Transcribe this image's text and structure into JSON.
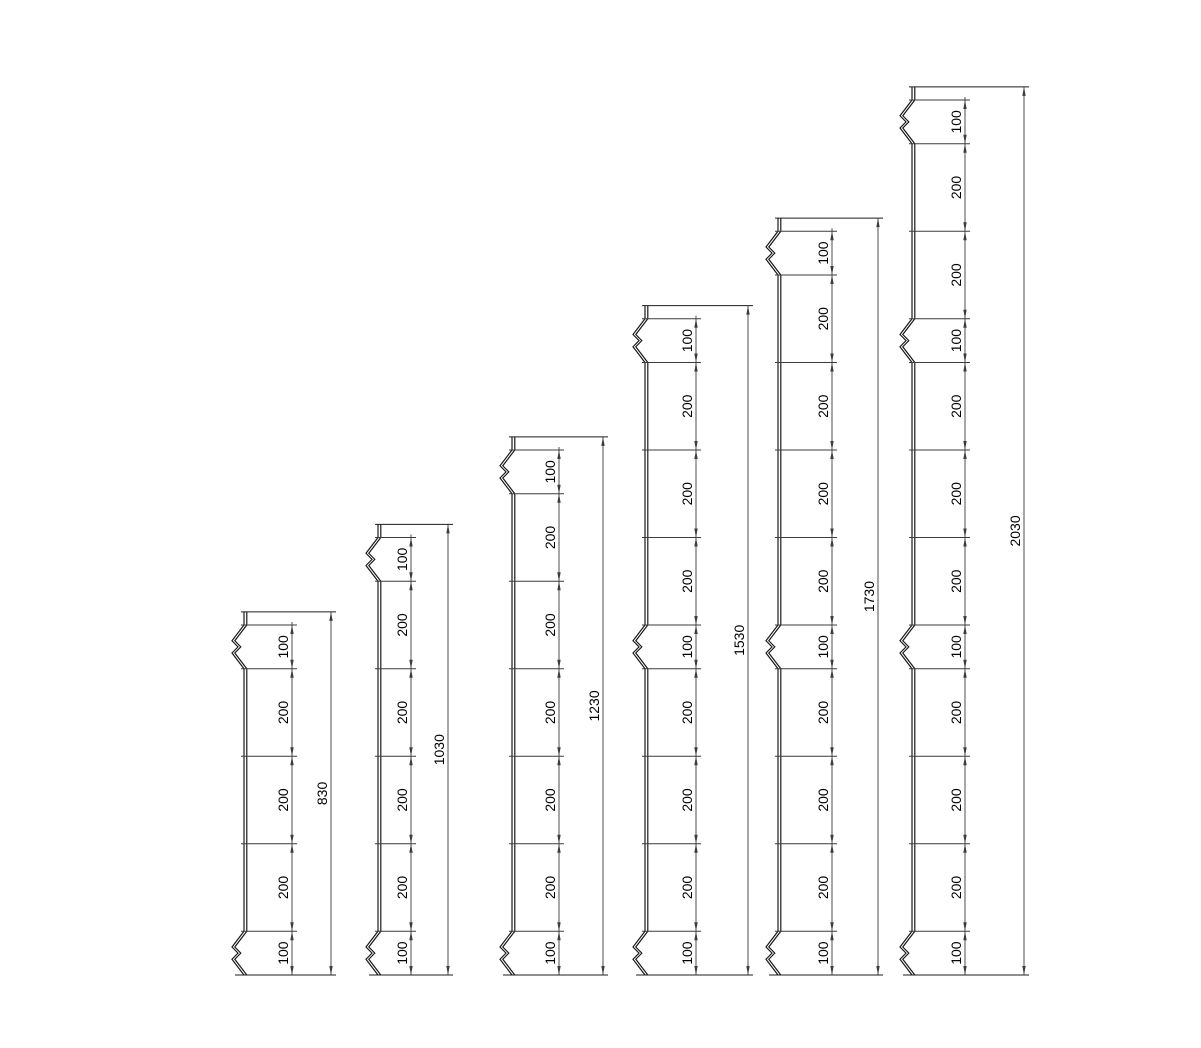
{
  "drawing": {
    "canvas": {
      "width": 1201,
      "height": 1048,
      "background": "#ffffff"
    },
    "style": {
      "profile_color": "#1c1c1c",
      "dimension_color": "#3c3c3c",
      "text_color": "#000000",
      "font_size_px": 14,
      "profile_stroke_px": 1.2,
      "dimension_stroke_px": 0.9
    },
    "units": "mm",
    "scale_px_per_mm": 0.4375,
    "baseline_y_px": 975,
    "top_cap_mm": 30,
    "crimp_shape": {
      "depth_px": 12,
      "notch_px": 6,
      "apex1_frac": 0.36,
      "mid_frac": 0.5,
      "apex2_frac": 0.64,
      "double_line_gap_px": 2.8
    },
    "posts": [
      {
        "name": "post-830",
        "overall_label": "830",
        "overall_mm": 830,
        "segments_mm": [
          100,
          200,
          200,
          200,
          100
        ],
        "segment_labels": [
          "100",
          "200",
          "200",
          "200",
          "100"
        ],
        "crimp_segments": [
          0,
          4
        ],
        "x_left_px": 244,
        "x_chain_px": 292,
        "x_dim_px": 331
      },
      {
        "name": "post-1030",
        "overall_label": "1030",
        "overall_mm": 1030,
        "segments_mm": [
          100,
          200,
          200,
          200,
          200,
          100
        ],
        "segment_labels": [
          "100",
          "200",
          "200",
          "200",
          "200",
          "100"
        ],
        "crimp_segments": [
          0,
          5
        ],
        "x_left_px": 378,
        "x_chain_px": 411,
        "x_dim_px": 448
      },
      {
        "name": "post-1230",
        "overall_label": "1230",
        "overall_mm": 1230,
        "segments_mm": [
          100,
          200,
          200,
          200,
          200,
          200,
          100
        ],
        "segment_labels": [
          "100",
          "200",
          "200",
          "200",
          "200",
          "200",
          "100"
        ],
        "crimp_segments": [
          0,
          6
        ],
        "x_left_px": 512,
        "x_chain_px": 559,
        "x_dim_px": 603
      },
      {
        "name": "post-1530",
        "overall_label": "1530",
        "overall_mm": 1530,
        "segments_mm": [
          100,
          200,
          200,
          200,
          100,
          200,
          200,
          200,
          100
        ],
        "segment_labels": [
          "100",
          "200",
          "200",
          "200",
          "100",
          "200",
          "200",
          "200",
          "100"
        ],
        "crimp_segments": [
          0,
          4,
          8
        ],
        "x_left_px": 645,
        "x_chain_px": 696,
        "x_dim_px": 748
      },
      {
        "name": "post-1730",
        "overall_label": "1730",
        "overall_mm": 1730,
        "segments_mm": [
          100,
          200,
          200,
          200,
          200,
          100,
          200,
          200,
          200,
          100
        ],
        "segment_labels": [
          "100",
          "200",
          "200",
          "200",
          "200",
          "100",
          "200",
          "200",
          "200",
          "100"
        ],
        "crimp_segments": [
          0,
          5,
          9
        ],
        "x_left_px": 778,
        "x_chain_px": 832,
        "x_dim_px": 878
      },
      {
        "name": "post-2030",
        "overall_label": "2030",
        "overall_mm": 2030,
        "segments_mm": [
          100,
          200,
          200,
          100,
          200,
          200,
          200,
          100,
          200,
          200,
          200,
          100
        ],
        "segment_labels": [
          "100",
          "200",
          "200",
          "100",
          "200",
          "200",
          "200",
          "100",
          "200",
          "200",
          "200",
          "100"
        ],
        "crimp_segments": [
          0,
          3,
          7,
          11
        ],
        "x_left_px": 912,
        "x_chain_px": 965,
        "x_dim_px": 1024
      }
    ]
  }
}
